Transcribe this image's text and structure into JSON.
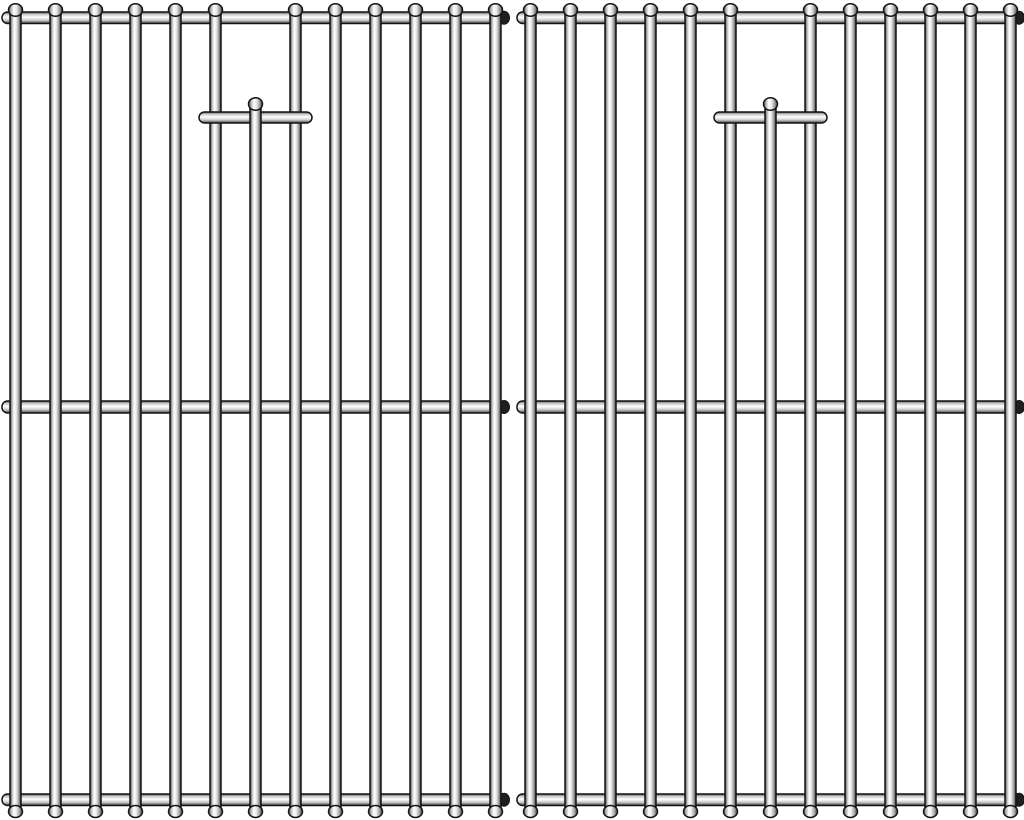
{
  "image": {
    "kind": "product-photo",
    "subject": "Two stainless steel BBQ grill replacement cooking grates, front view on white background",
    "grate_count": 2
  },
  "canvas": {
    "width": 1024,
    "height": 820
  },
  "grate": {
    "offsets": [
      0,
      515
    ],
    "frame_left_x": 2,
    "frame_right_x": 504,
    "rod_count": 13,
    "first_rod_center": 15.5,
    "rod_spacing": 40,
    "rod_width": 11,
    "rod_top_y": 4,
    "rod_bottom_y": 817,
    "short_rod_index": 6,
    "short_rod_top_y": 98,
    "crossbars": [
      {
        "y": 12,
        "height": 11.5
      },
      {
        "y": 401,
        "height": 12
      },
      {
        "y": 794,
        "height": 11.5
      }
    ],
    "bracket": {
      "left": 199,
      "right": 312,
      "y": 112,
      "height": 11
    }
  },
  "colors": {
    "background": "#ffffff",
    "outline": "#141414",
    "end_cap": "#1f1f1f",
    "rod_gradient": [
      "#3f3f3f",
      "#b5b5b5",
      "#ffffff",
      "#e8e8e8",
      "#969696",
      "#343434"
    ],
    "bar_gradient": [
      "#4a4a4a",
      "#c9c9c9",
      "#ffffff",
      "#cccccc",
      "#3e3e3e"
    ]
  }
}
